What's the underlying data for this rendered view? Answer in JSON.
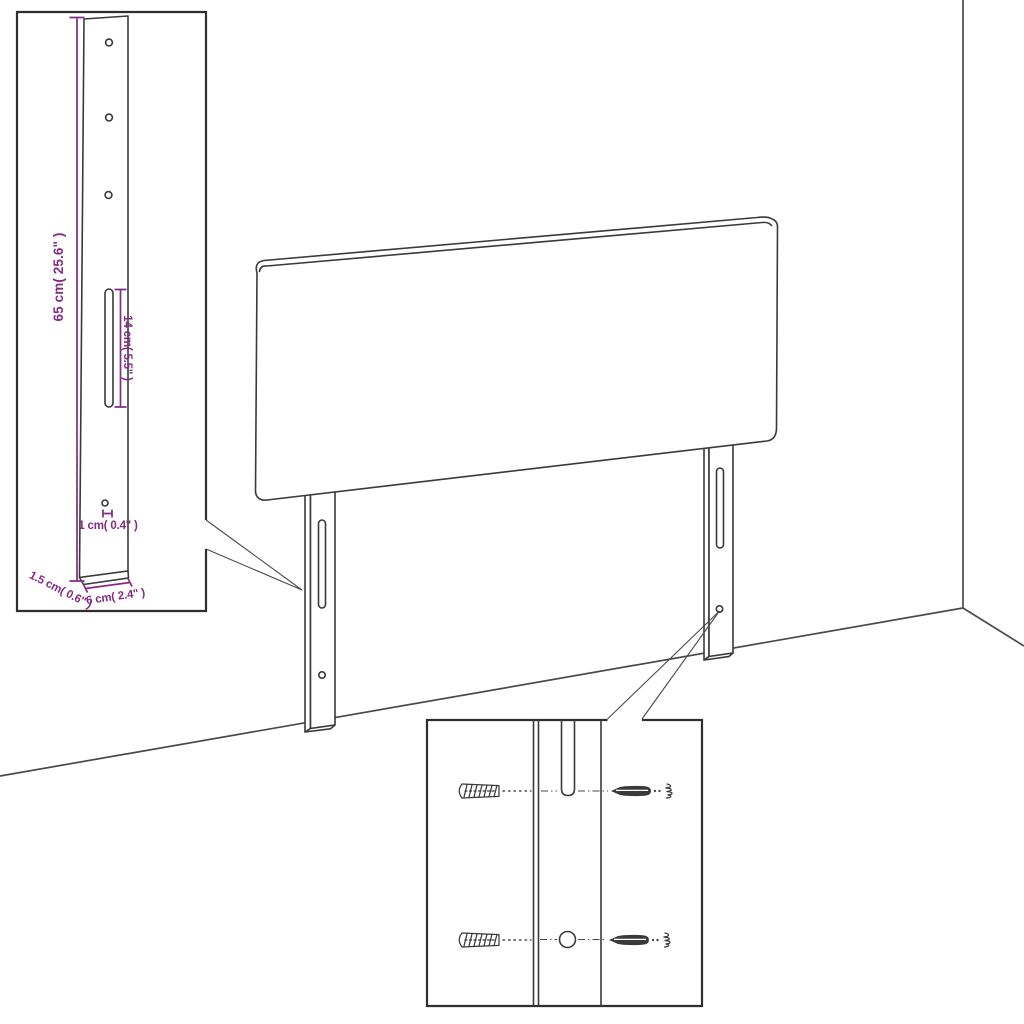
{
  "page": {
    "background": "#ffffff",
    "kind": "furniture assembly diagram"
  },
  "colors": {
    "line": "#3a3a3a",
    "wall_line": "#4a4a4a",
    "dimension_accent": "#822c82"
  },
  "main_view": {
    "subject": "headboard panel with two slotted mounting legs in room corner"
  },
  "detail_insets": {
    "leg_dimensions": {
      "labels": {
        "leg_height": "65 cm( 25.6\" )",
        "slot_length": "14 cm( 5.5\" )",
        "hole_diameter": "1 cm( 0.4\" )",
        "leg_thickness": "1.5 cm( 0.6\" )",
        "leg_width": "6 cm( 2.4\" )"
      }
    },
    "mounting_hardware": {
      "icons": [
        "wall-plug-icon",
        "screw-icon"
      ]
    }
  }
}
